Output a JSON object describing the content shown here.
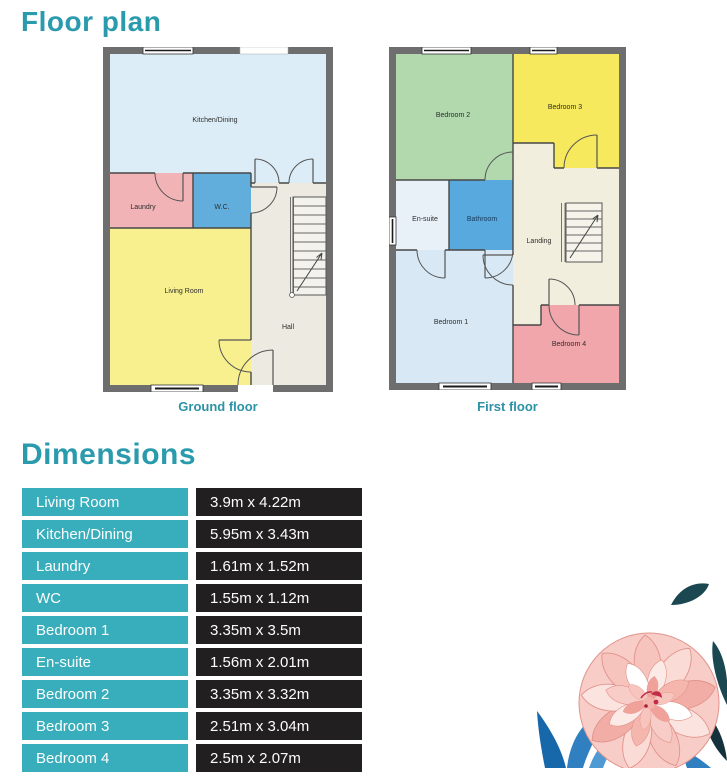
{
  "header": {
    "title": "Floor plan"
  },
  "plans": {
    "ground": {
      "caption": "Ground floor",
      "rooms": [
        {
          "name": "Kitchen/Dining",
          "color": "#dcedf7"
        },
        {
          "name": "Laundry",
          "color": "#f2b3b7"
        },
        {
          "name": "W.C.",
          "color": "#61aedd"
        },
        {
          "name": "Living Room",
          "color": "#f8f08f"
        },
        {
          "name": "Hall",
          "color": "#edeae1"
        }
      ]
    },
    "first": {
      "caption": "First floor",
      "rooms": [
        {
          "name": "Bedroom 2",
          "color": "#b2d8ae"
        },
        {
          "name": "Bedroom 3",
          "color": "#f6e95e"
        },
        {
          "name": "En-suite",
          "color": "#e8f1f8"
        },
        {
          "name": "Bathroom",
          "color": "#58aade"
        },
        {
          "name": "Landing",
          "color": "#f2eedd"
        },
        {
          "name": "Bedroom 1",
          "color": "#d8e9f5"
        },
        {
          "name": "Bedroom 4",
          "color": "#f1a6ab"
        }
      ]
    }
  },
  "dimensions": {
    "title": "Dimensions",
    "rows": [
      {
        "room": "Living Room",
        "size": "3.9m x 4.22m"
      },
      {
        "room": "Kitchen/Dining",
        "size": "5.95m x 3.43m"
      },
      {
        "room": "Laundry",
        "size": "1.61m x 1.52m"
      },
      {
        "room": "WC",
        "size": "1.55m x 1.12m"
      },
      {
        "room": "Bedroom 1",
        "size": "3.35m x 3.5m"
      },
      {
        "room": "En-suite",
        "size": "1.56m x 2.01m"
      },
      {
        "room": "Bedroom 2",
        "size": "3.35m x 3.32m"
      },
      {
        "room": "Bedroom 3",
        "size": "2.51m x 3.04m"
      },
      {
        "room": "Bedroom 4",
        "size": "2.5m x 2.07m"
      }
    ]
  },
  "colors": {
    "accent_teal": "#2a9aad",
    "caption_teal": "#2b93a5",
    "table_label_bg": "#38aebc",
    "table_value_bg": "#221f20",
    "wall_gray": "#6e6e6e"
  }
}
